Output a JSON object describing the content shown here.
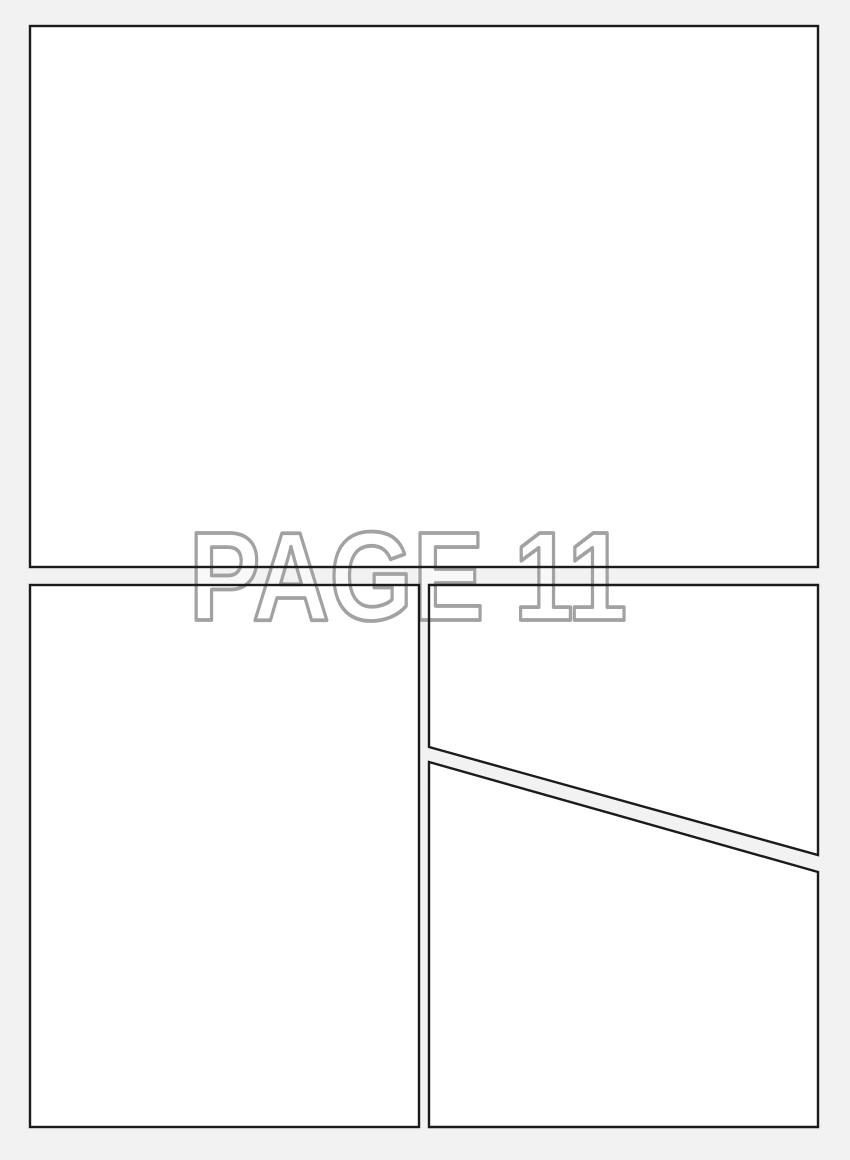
{
  "watermark": {
    "text": "PAGE 11"
  },
  "colors": {
    "background": "#f2f2f2",
    "panel_fill": "#ffffff",
    "panel_border": "#1b1b1b",
    "watermark_stroke": "#a2a2a2"
  }
}
